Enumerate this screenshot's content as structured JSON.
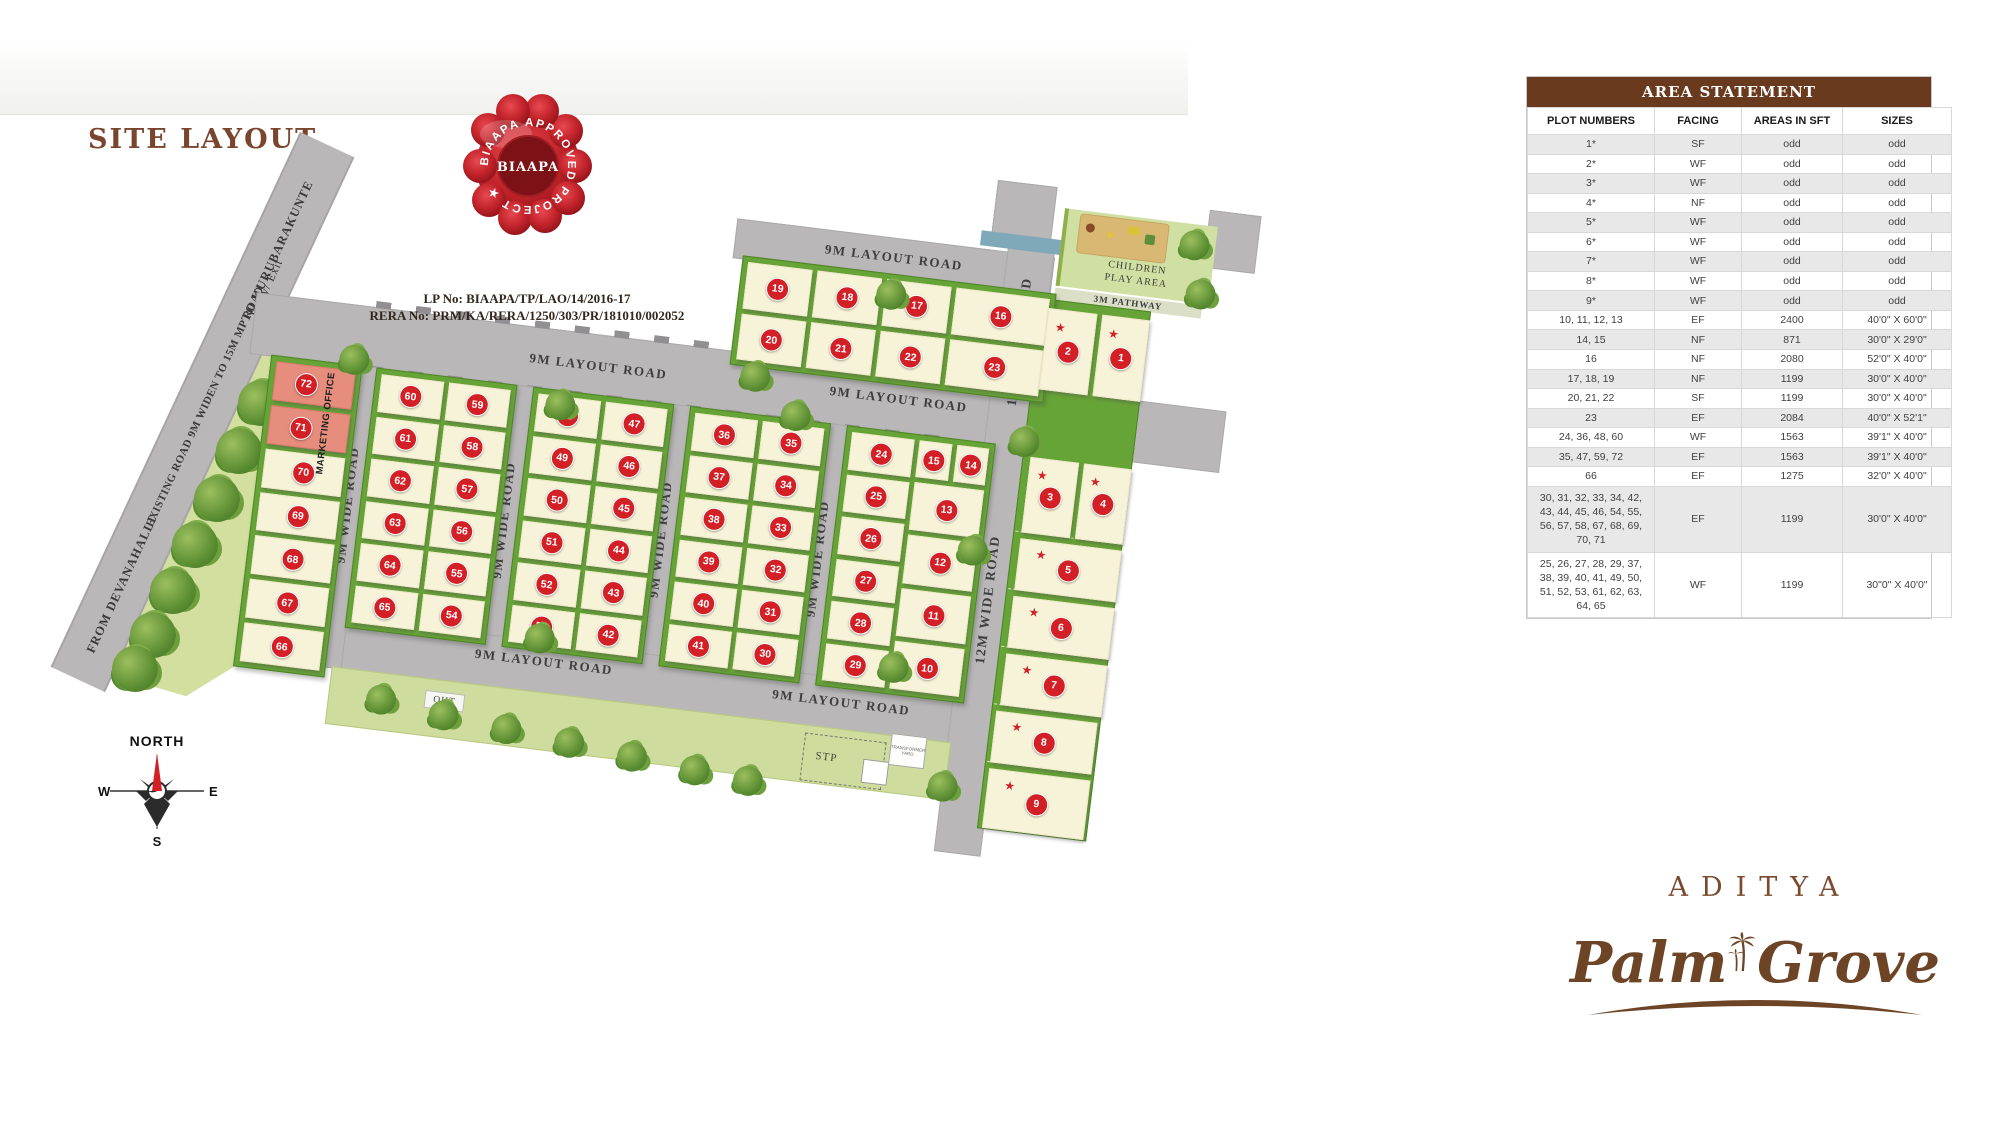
{
  "header": {
    "title": "SITE LAYOUT",
    "lp_no": "LP No: BIAAPA/TP/LAO/14/2016-17",
    "rera_no": "RERA No: PRM/KA/RERA/1250/303/PR/181010/002052"
  },
  "seal": {
    "ring_text": "BIAAPA APPROVED PROJECT ★",
    "center_text": "BIAAPA"
  },
  "roads": {
    "layout_road": "9M LAYOUT ROAD",
    "wide_road_9m": "9M WIDE ROAD",
    "wide_road_12m": "12M WIDE ROAD",
    "to_kurubarakunte": "TO KURUBARAKUNTE",
    "existing_road": "EXISTING ROAD 9M WIDEN TO 15M MP ROAD",
    "from_devanahalli": "FROM DEVANAHALLI",
    "entry_exit": "Entry/ Exit",
    "pathway": "3M PATHWAY"
  },
  "areas": {
    "ca_area": "CA AREA",
    "children_line1": "CHILDREN",
    "children_line2": "PLAY AREA",
    "marketing_office": "MARKETING OFFICE",
    "oht": "OHT",
    "stp": "STP",
    "transformer_yard": "TRANSFORMER YARD"
  },
  "compass": {
    "north": "NORTH",
    "west": "W",
    "east": "E",
    "south": "S"
  },
  "logo": {
    "brand": "ADITYA",
    "palm": "Palm",
    "grove": "Grove"
  },
  "icons": {
    "star": "★"
  },
  "plots": {
    "left_col": [
      "72",
      "71",
      "70",
      "69",
      "68",
      "67",
      "66"
    ],
    "top_row1": [
      "19",
      "18",
      "17",
      "16"
    ],
    "top_row2": [
      "20",
      "21",
      "22",
      "23"
    ],
    "c1_left": [
      "60",
      "61",
      "62",
      "63",
      "64",
      "65"
    ],
    "c1_right": [
      "59",
      "58",
      "57",
      "56",
      "55",
      "54"
    ],
    "c2_left": [
      "48",
      "49",
      "50",
      "51",
      "52",
      "53"
    ],
    "c2_right": [
      "47",
      "46",
      "45",
      "44",
      "43",
      "42"
    ],
    "c3_left": [
      "36",
      "37",
      "38",
      "39",
      "40",
      "41"
    ],
    "c3_right": [
      "35",
      "34",
      "33",
      "32",
      "31",
      "30"
    ],
    "c4_left": [
      "24",
      "25",
      "26",
      "27",
      "28",
      "29"
    ],
    "c4_small": [
      "15",
      "14"
    ],
    "c4_large": [
      "13",
      "12",
      "11",
      "10"
    ],
    "rc_pair1": [
      "2",
      "1"
    ],
    "rc_pair2": [
      "3",
      "4"
    ],
    "rc_singles": [
      "5",
      "6",
      "7",
      "8",
      "9"
    ]
  },
  "table": {
    "title": "AREA STATEMENT",
    "columns": [
      "PLOT NUMBERS",
      "FACING",
      "AREAS IN SFT",
      "SIZES"
    ],
    "rows": [
      {
        "plots": "1*",
        "facing": "SF",
        "area": "odd",
        "size": "odd"
      },
      {
        "plots": "2*",
        "facing": "WF",
        "area": "odd",
        "size": "odd"
      },
      {
        "plots": "3*",
        "facing": "WF",
        "area": "odd",
        "size": "odd"
      },
      {
        "plots": "4*",
        "facing": "NF",
        "area": "odd",
        "size": "odd"
      },
      {
        "plots": "5*",
        "facing": "WF",
        "area": "odd",
        "size": "odd"
      },
      {
        "plots": "6*",
        "facing": "WF",
        "area": "odd",
        "size": "odd"
      },
      {
        "plots": "7*",
        "facing": "WF",
        "area": "odd",
        "size": "odd"
      },
      {
        "plots": "8*",
        "facing": "WF",
        "area": "odd",
        "size": "odd"
      },
      {
        "plots": "9*",
        "facing": "WF",
        "area": "odd",
        "size": "odd"
      },
      {
        "plots": "10, 11, 12, 13",
        "facing": "EF",
        "area": "2400",
        "size": "40'0\" X 60'0\""
      },
      {
        "plots": "14, 15",
        "facing": "NF",
        "area": "871",
        "size": "30'0\" X 29'0\""
      },
      {
        "plots": "16",
        "facing": "NF",
        "area": "2080",
        "size": "52'0\" X 40'0\""
      },
      {
        "plots": "17, 18, 19",
        "facing": "NF",
        "area": "1199",
        "size": "30'0\" X 40'0\""
      },
      {
        "plots": "20, 21, 22",
        "facing": "SF",
        "area": "1199",
        "size": "30'0\" X 40'0\""
      },
      {
        "plots": "23",
        "facing": "EF",
        "area": "2084",
        "size": "40'0\" X 52'1\""
      },
      {
        "plots": "24, 36, 48, 60",
        "facing": "WF",
        "area": "1563",
        "size": "39'1\" X 40'0\""
      },
      {
        "plots": "35, 47, 59, 72",
        "facing": "EF",
        "area": "1563",
        "size": "39'1\" X 40'0\""
      },
      {
        "plots": "66",
        "facing": "EF",
        "area": "1275",
        "size": "32'0\" X 40'0\""
      },
      {
        "plots": "30, 31, 32, 33, 34, 42, 43, 44, 45, 46, 54, 55, 56, 57, 58, 67, 68, 69, 70, 71",
        "facing": "EF",
        "area": "1199",
        "size": "30'0\" X 40'0\""
      },
      {
        "plots": "25, 26, 27, 28, 29, 37, 38, 39, 40, 41, 49, 50, 51, 52, 53, 61, 62, 63, 64, 65",
        "facing": "WF",
        "area": "1199",
        "size": "30\"0\" X 40'0\""
      }
    ]
  }
}
